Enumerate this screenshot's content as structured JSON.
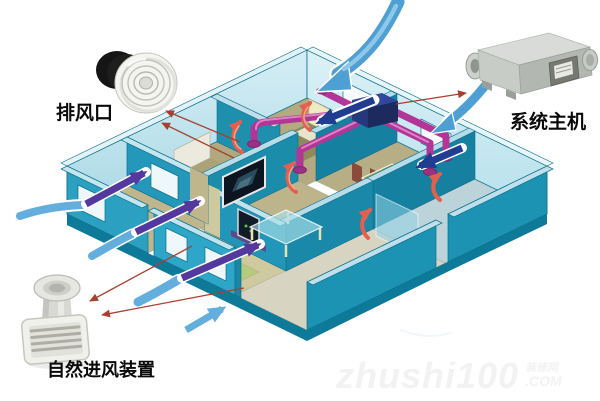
{
  "figure": {
    "components": [
      {
        "id": "exhaust-vent",
        "label": "排风口"
      },
      {
        "id": "system-main-unit",
        "label": "系统主机"
      },
      {
        "id": "natural-intake-device",
        "label": "自然进风装置"
      }
    ],
    "watermark": {
      "main": "zhushi100",
      "small_top": "装修网",
      "small_bottom": ".COM"
    },
    "colors": {
      "outer_wall_teal": "#1d93b4",
      "front_wall_teal": "#2ea6c8",
      "inner_wall_cyan": "#bfe5ef",
      "floor_tan": "#b8ae86",
      "duct_magenta": "#b13697",
      "fresh_air_blue": "#4d9fd4",
      "window_arrow_navy": "#203d92",
      "indoor_arrow_purple": "#53399e",
      "exhaust_arrow_red": "#e4604e",
      "leader_line_red": "#a84030",
      "unit_box_navy": "#31479e",
      "green_mat": "#b5cc7e"
    }
  }
}
